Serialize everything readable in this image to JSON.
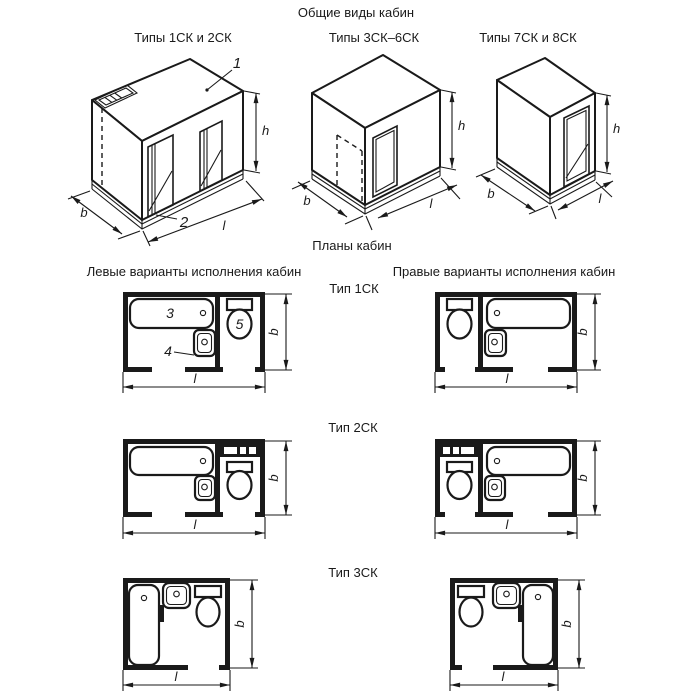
{
  "title": "Общие виды кабин",
  "iso_views": [
    {
      "caption": "Типы 1СК и 2СК"
    },
    {
      "caption": "Типы 3СК–6СК"
    },
    {
      "caption": "Типы 7СК и 8СК"
    }
  ],
  "plans": {
    "title": "Планы кабин",
    "left_column_header": "Левые варианты исполнения кабин",
    "right_column_header": "Правые варианты исполнения кабин",
    "rows": [
      {
        "label": "Тип 1СК"
      },
      {
        "label": "Тип 2СК"
      },
      {
        "label": "Тип 3СК"
      }
    ]
  },
  "dims": {
    "height": "h",
    "width": "b",
    "length": "l"
  },
  "callouts": {
    "ceiling_panel": "1",
    "floor_panel": "2",
    "bathtub": "3",
    "washbasin": "4",
    "toilet": "5"
  },
  "colors": {
    "line": "#1a1a1a",
    "background": "#ffffff"
  }
}
